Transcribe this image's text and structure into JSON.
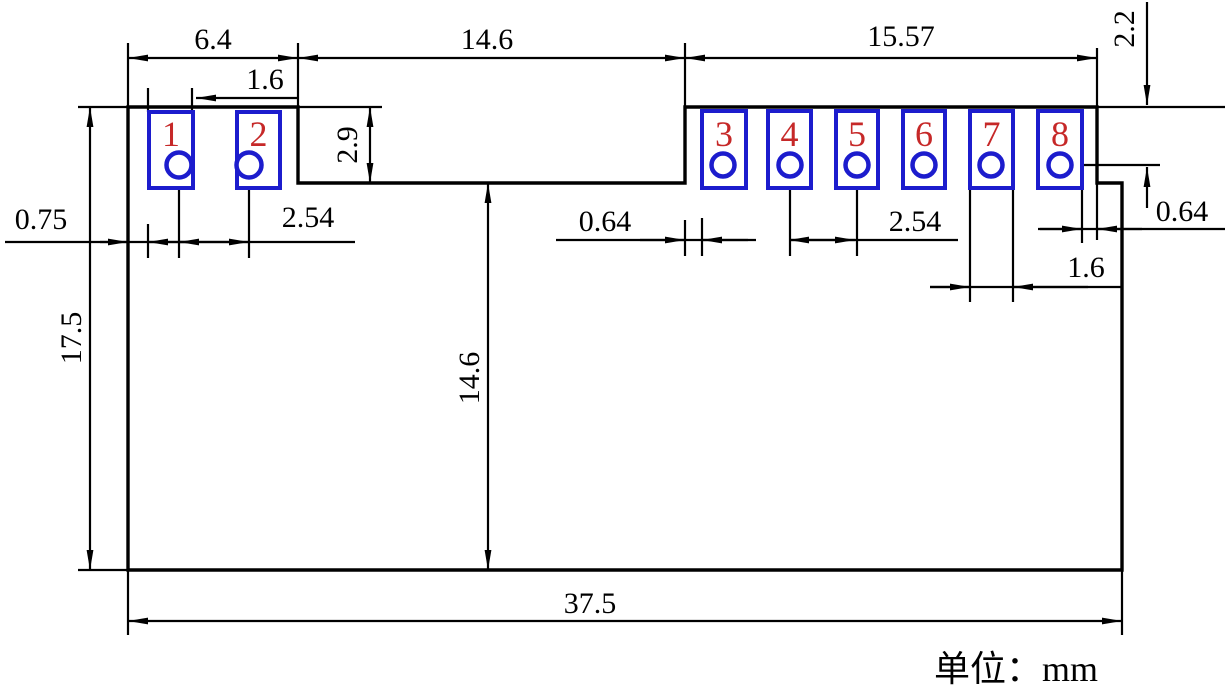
{
  "drawing": {
    "unit_note": "单位：mm",
    "pads": [
      {
        "number": "1"
      },
      {
        "number": "2"
      },
      {
        "number": "3"
      },
      {
        "number": "4"
      },
      {
        "number": "5"
      },
      {
        "number": "6"
      },
      {
        "number": "7"
      },
      {
        "number": "8"
      }
    ],
    "dims": {
      "block_left_width": "6.4",
      "pad_left_width": "1.6",
      "notch_width": "14.6",
      "block_right_width": "15.57",
      "hole_offset_top_right": "2.2",
      "block_left_height": "2.9",
      "edge_to_pad_left": "0.75",
      "pitch_left": "2.54",
      "height_total": "17.5",
      "edge_to_pad_right": "0.64",
      "notch_depth": "14.6",
      "pitch_right": "2.54",
      "hole_offset_right": "0.64",
      "pad8_edge_gap": "0.64",
      "pad_right_width": "1.6",
      "width_total": "37.5"
    },
    "colors": {
      "line": "#000000",
      "pad_outline": "#1c1ccd",
      "pad_number": "#c62828",
      "background": "#ffffff"
    }
  }
}
